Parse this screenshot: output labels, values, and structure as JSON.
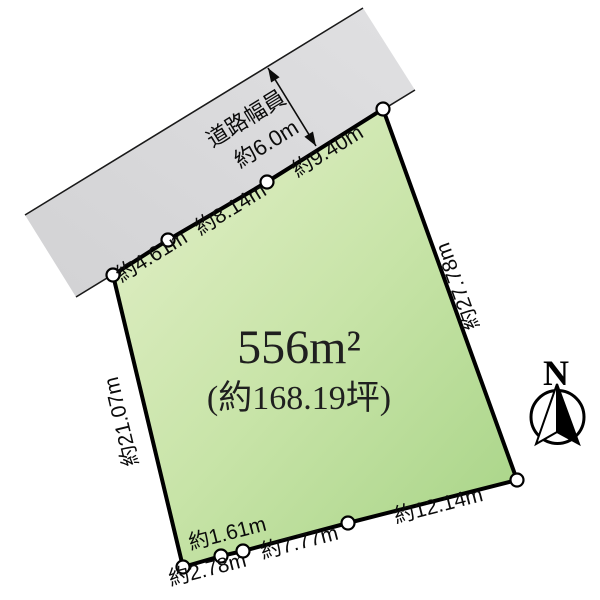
{
  "road": {
    "width_label_line1": "道路幅員",
    "width_label_line2": "約6.0m"
  },
  "plot": {
    "area_sqm": "556m²",
    "area_tsubo": "(約168.19坪)",
    "dimensions": {
      "top_edge": [
        "約4.61m",
        "約8.14m",
        "約9.40m"
      ],
      "right_edge": "約27.78m",
      "left_edge": "約21.07m",
      "bottom_edge": [
        "約2.78m",
        "約1.61m",
        "約7.77m",
        "約12.14m"
      ]
    },
    "vertex_count": 9
  },
  "compass": {
    "north_label": "N"
  },
  "colors": {
    "plot_fill_light": "#e4f0ca",
    "plot_fill_mid": "#c8e4a8",
    "plot_fill_dark": "#a6d385",
    "road_fill_light": "#e0e0e2",
    "road_fill_dark": "#d2d2d4",
    "outline": "#000000"
  }
}
